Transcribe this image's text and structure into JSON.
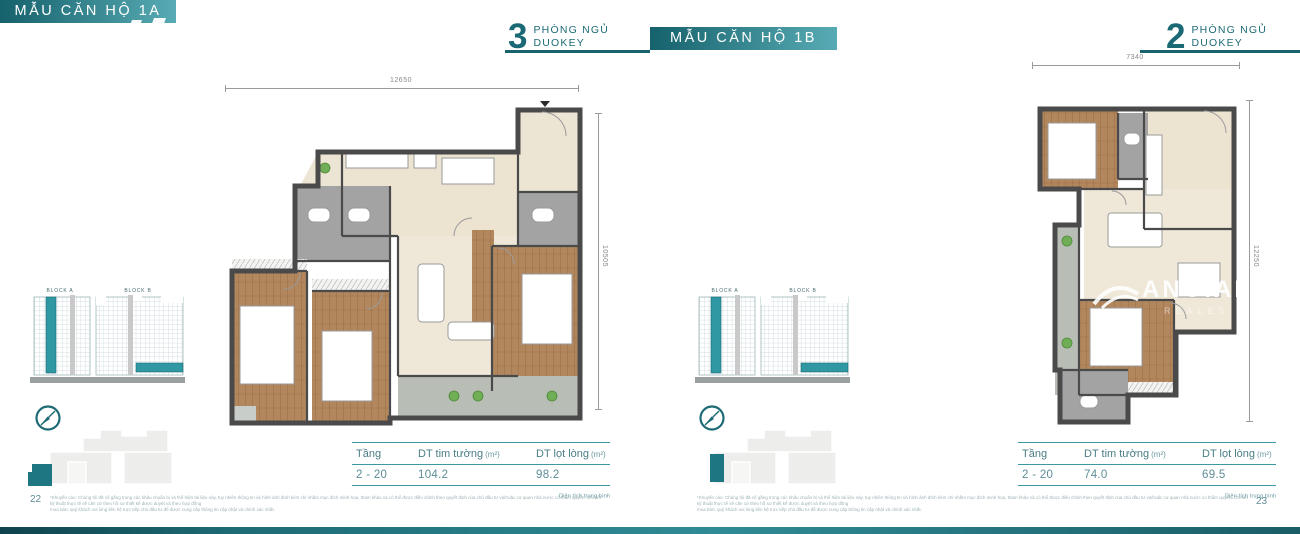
{
  "header": {
    "left_box_label": "MẪU CĂN HỘ 1A",
    "center_badge": {
      "number": "3",
      "room_label": "PHÒNG NGỦ",
      "key_label": "DUOKEY"
    },
    "center_box_label": "MẪU CĂN HỘ 1B",
    "right_badge": {
      "number": "2",
      "room_label": "PHÒNG NGỦ",
      "key_label": "DUOKEY"
    }
  },
  "block_diagram": {
    "block_a_label": "BLOCK A",
    "block_b_label": "BLOCK B"
  },
  "table_headers": {
    "floor": "Tầng",
    "gross": "DT tim tường",
    "net": "DT lọt lòng",
    "unit": "(m²)"
  },
  "left_unit": {
    "plan": {
      "top_dim": "12650",
      "side_dim": "10505"
    },
    "table": {
      "floor_range": "2 - 20",
      "gross_area": "104.2",
      "net_area": "98.2",
      "note": "Diện tích trung bình"
    },
    "page_number": "22"
  },
  "right_unit": {
    "plan": {
      "top_dim": "7340",
      "side_dim": "12250"
    },
    "table": {
      "floor_range": "2 - 20",
      "gross_area": "74.0",
      "net_area": "69.5",
      "note": "Diện tích trung bình"
    },
    "page_number": "23"
  },
  "watermark": {
    "brand": "ANGIALA",
    "sub": "REALES"
  },
  "disclaimer": {
    "line1": "*Khuyến cáo: Chúng tôi đã cố gắng trong các khâu chuẩn bị và thể hiện tài liệu này, tuy nhiên thông tin và hình ảnh đính kèm chỉ nhằm mục đích minh họa, tham khảo và có thể được điều chỉnh theo quyết định của chủ đầu tư và/hoặc cơ quan nhà nước có thẩm quyền. Chi tiết kỹ thuật thực tế sẽ căn cứ theo hồ sơ thiết kế được duyệt và theo hợp đồng",
    "line2": "mua bán; quý khách vui lòng liên hệ trực tiếp chủ đầu tư để được cung cấp thông tin cập nhật và chính xác nhất."
  },
  "colors": {
    "teal_dark": "#17646f",
    "teal": "#2f98a3",
    "wall": "#4a4a4a",
    "wood": "#b3875e",
    "beige": "#ece4d1",
    "room_gray": "#a3a3a3"
  }
}
